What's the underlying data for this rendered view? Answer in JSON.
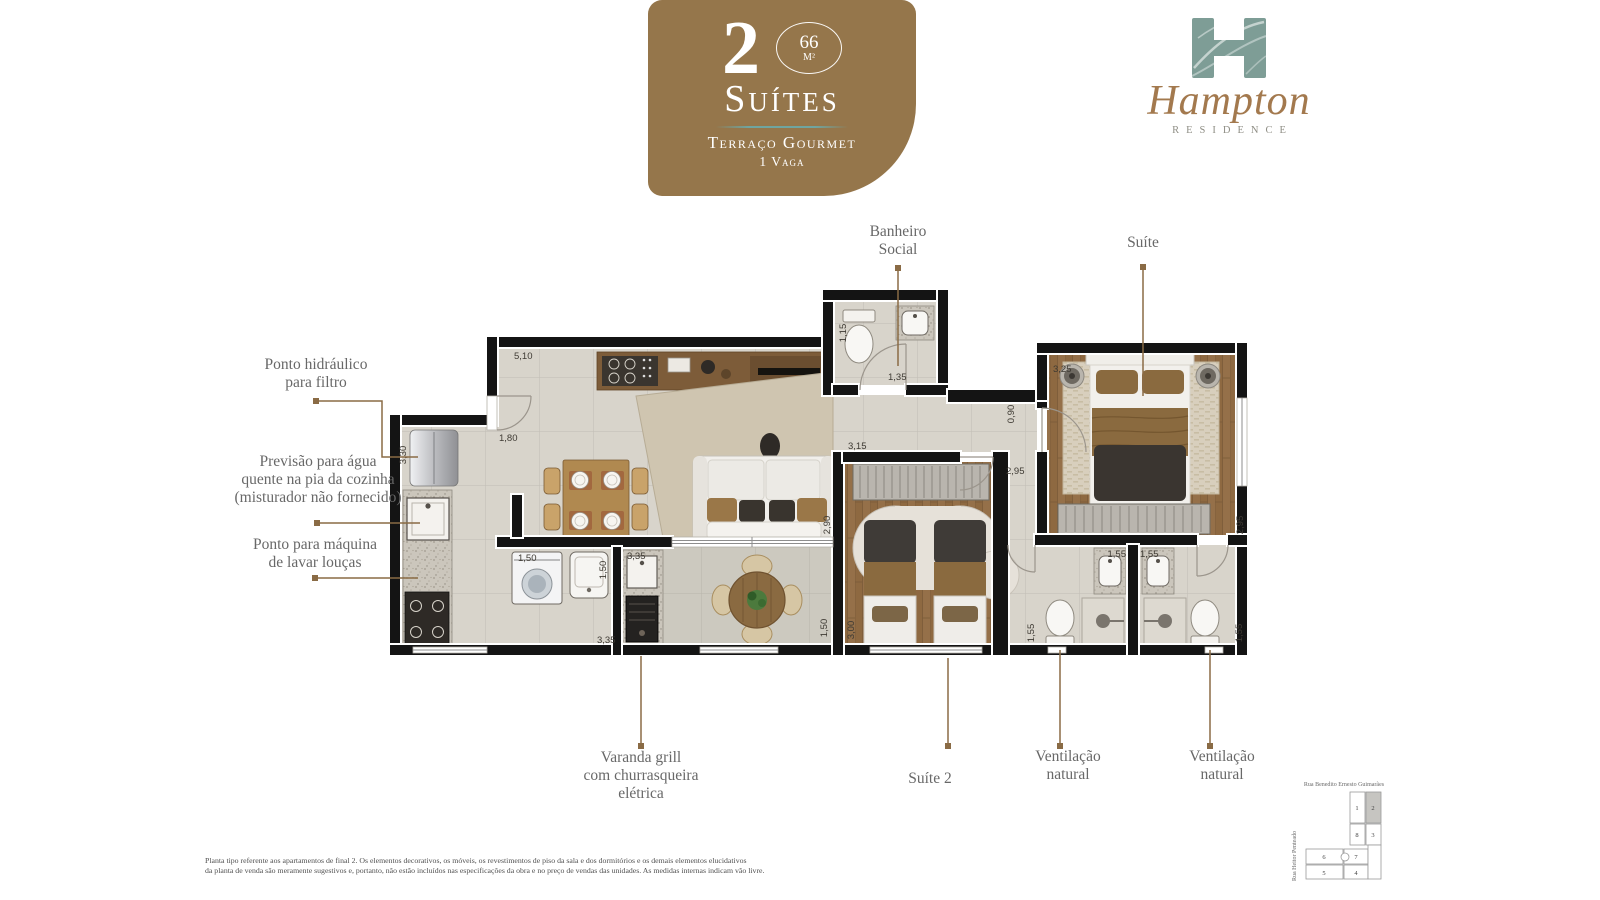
{
  "badge": {
    "number": "2",
    "area_value": "66",
    "area_unit": "M²",
    "title": "Suítes",
    "feature_line1": "Terraço Gourmet",
    "feature_line2": "1 Vaga",
    "background_color": "#95764b",
    "divider_color": "#6fa5a0"
  },
  "logo": {
    "name": "Hampton",
    "subtitle": "RESIDENCE",
    "monogram_color": "#7e9d96",
    "name_color": "#a3794e"
  },
  "callouts": {
    "ponto_hidraulico": {
      "lines": [
        "Ponto hidráulico",
        "para filtro"
      ]
    },
    "previsao_agua": {
      "lines": [
        "Previsão para água",
        "quente na pia da cozinha",
        "(misturador não fornecido)"
      ]
    },
    "ponto_maquina": {
      "lines": [
        "Ponto para máquina",
        "de lavar louças"
      ]
    },
    "banheiro_social": {
      "lines": [
        "Banheiro",
        "Social"
      ]
    },
    "suite": {
      "lines": [
        "Suíte"
      ]
    },
    "varanda_grill": {
      "lines": [
        "Varanda grill",
        "com churrasqueira",
        "elétrica"
      ]
    },
    "suite2": {
      "lines": [
        "Suíte 2"
      ]
    },
    "ventilacao_1": {
      "lines": [
        "Ventilação",
        "natural"
      ]
    },
    "ventilacao_2": {
      "lines": [
        "Ventilação",
        "natural"
      ]
    }
  },
  "dimensions": {
    "living_top": "5,10",
    "kitchen_left": "3,30",
    "entry": "1,80",
    "washer": "1,50",
    "laundry_right": "1,50",
    "grill_top": "3,35",
    "grill_bottom": "3,35",
    "wc_width": "1,15",
    "wc_door": "1,35",
    "hall_width": "0,90",
    "suite2_top": "3,15",
    "suite2_door": "2,95",
    "living_right": "2,90",
    "suite2_left": "3,00",
    "terrace_right": "1,50",
    "suite1_top": "3,25",
    "suite1_right": "2,95",
    "bath1_sink": "1,55",
    "bath2_sink": "1,55",
    "bath1_toilet": "1,55",
    "bath2_toilet": "1,55"
  },
  "keyplan": {
    "street_top": "Rua Benedito Ernesto Guimarães",
    "street_left": "Rua Heitor Penteado",
    "units": [
      "1",
      "2",
      "3",
      "4",
      "5",
      "6",
      "7",
      "8"
    ],
    "highlighted_unit": "2"
  },
  "disclaimer": {
    "line1": "Planta tipo referente aos apartamentos de final 2. Os elementos decorativos, os móveis, os revestimentos de piso da sala e dos dormitórios e os demais elementos elucidativos",
    "line2": "da planta de venda são meramente sugestivos e, portanto, não estão incluídos nas especificações da obra e no preço de vendas das unidades. As medidas internas indicam vão livre."
  },
  "colors": {
    "leader_line": "#8a6b45",
    "wall": "#141414",
    "label_text": "#686868",
    "dimension_text": "#3e3a33",
    "wood_floor": "#8e6941",
    "tile_floor": "#d8d4cb"
  }
}
